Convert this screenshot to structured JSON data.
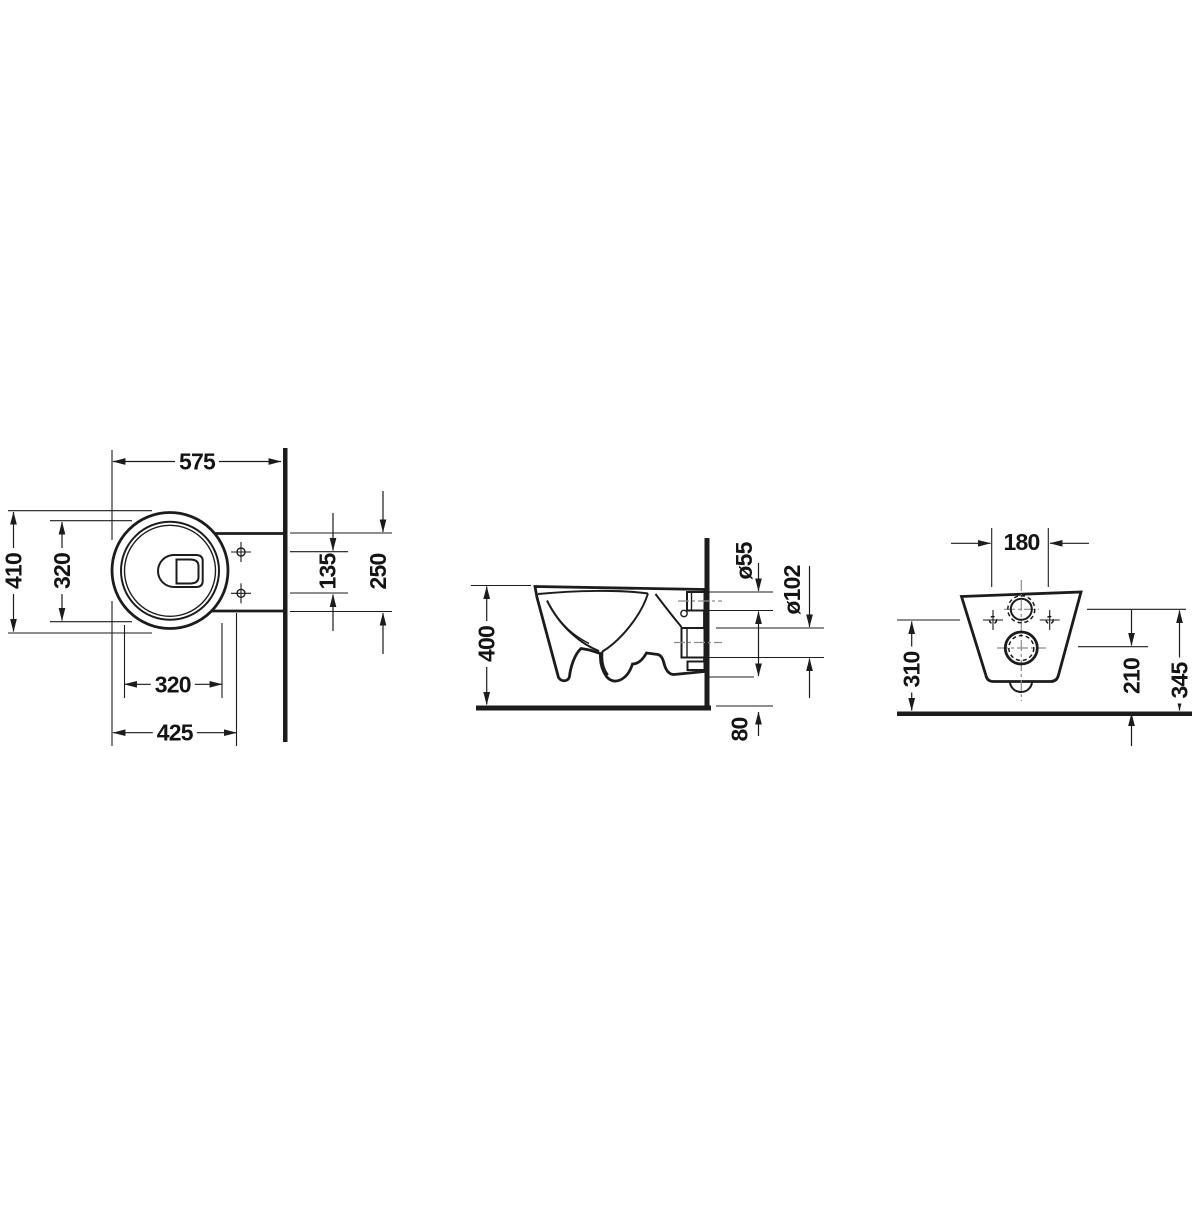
{
  "drawing": {
    "background": "#ffffff",
    "line_color": "#1c1c1c",
    "centerline_color": "#8c8c8c",
    "views": {
      "top": {
        "dims": {
          "overall_depth": "575",
          "outer_width": "410",
          "inner_width": "320",
          "inner_length": "320",
          "front_to_fixing": "425",
          "fixing_hole_gap": "135",
          "rear_width": "250"
        }
      },
      "side": {
        "dims": {
          "rim_height": "400",
          "inlet_diameter": "ø55",
          "outlet_diameter": "ø102",
          "floor_clearance": "80"
        }
      },
      "rear": {
        "dims": {
          "fixing_hole_spacing": "180",
          "fixing_hole_height": "310",
          "outlet_center_height": "210",
          "inlet_center_height": "345"
        }
      }
    }
  }
}
